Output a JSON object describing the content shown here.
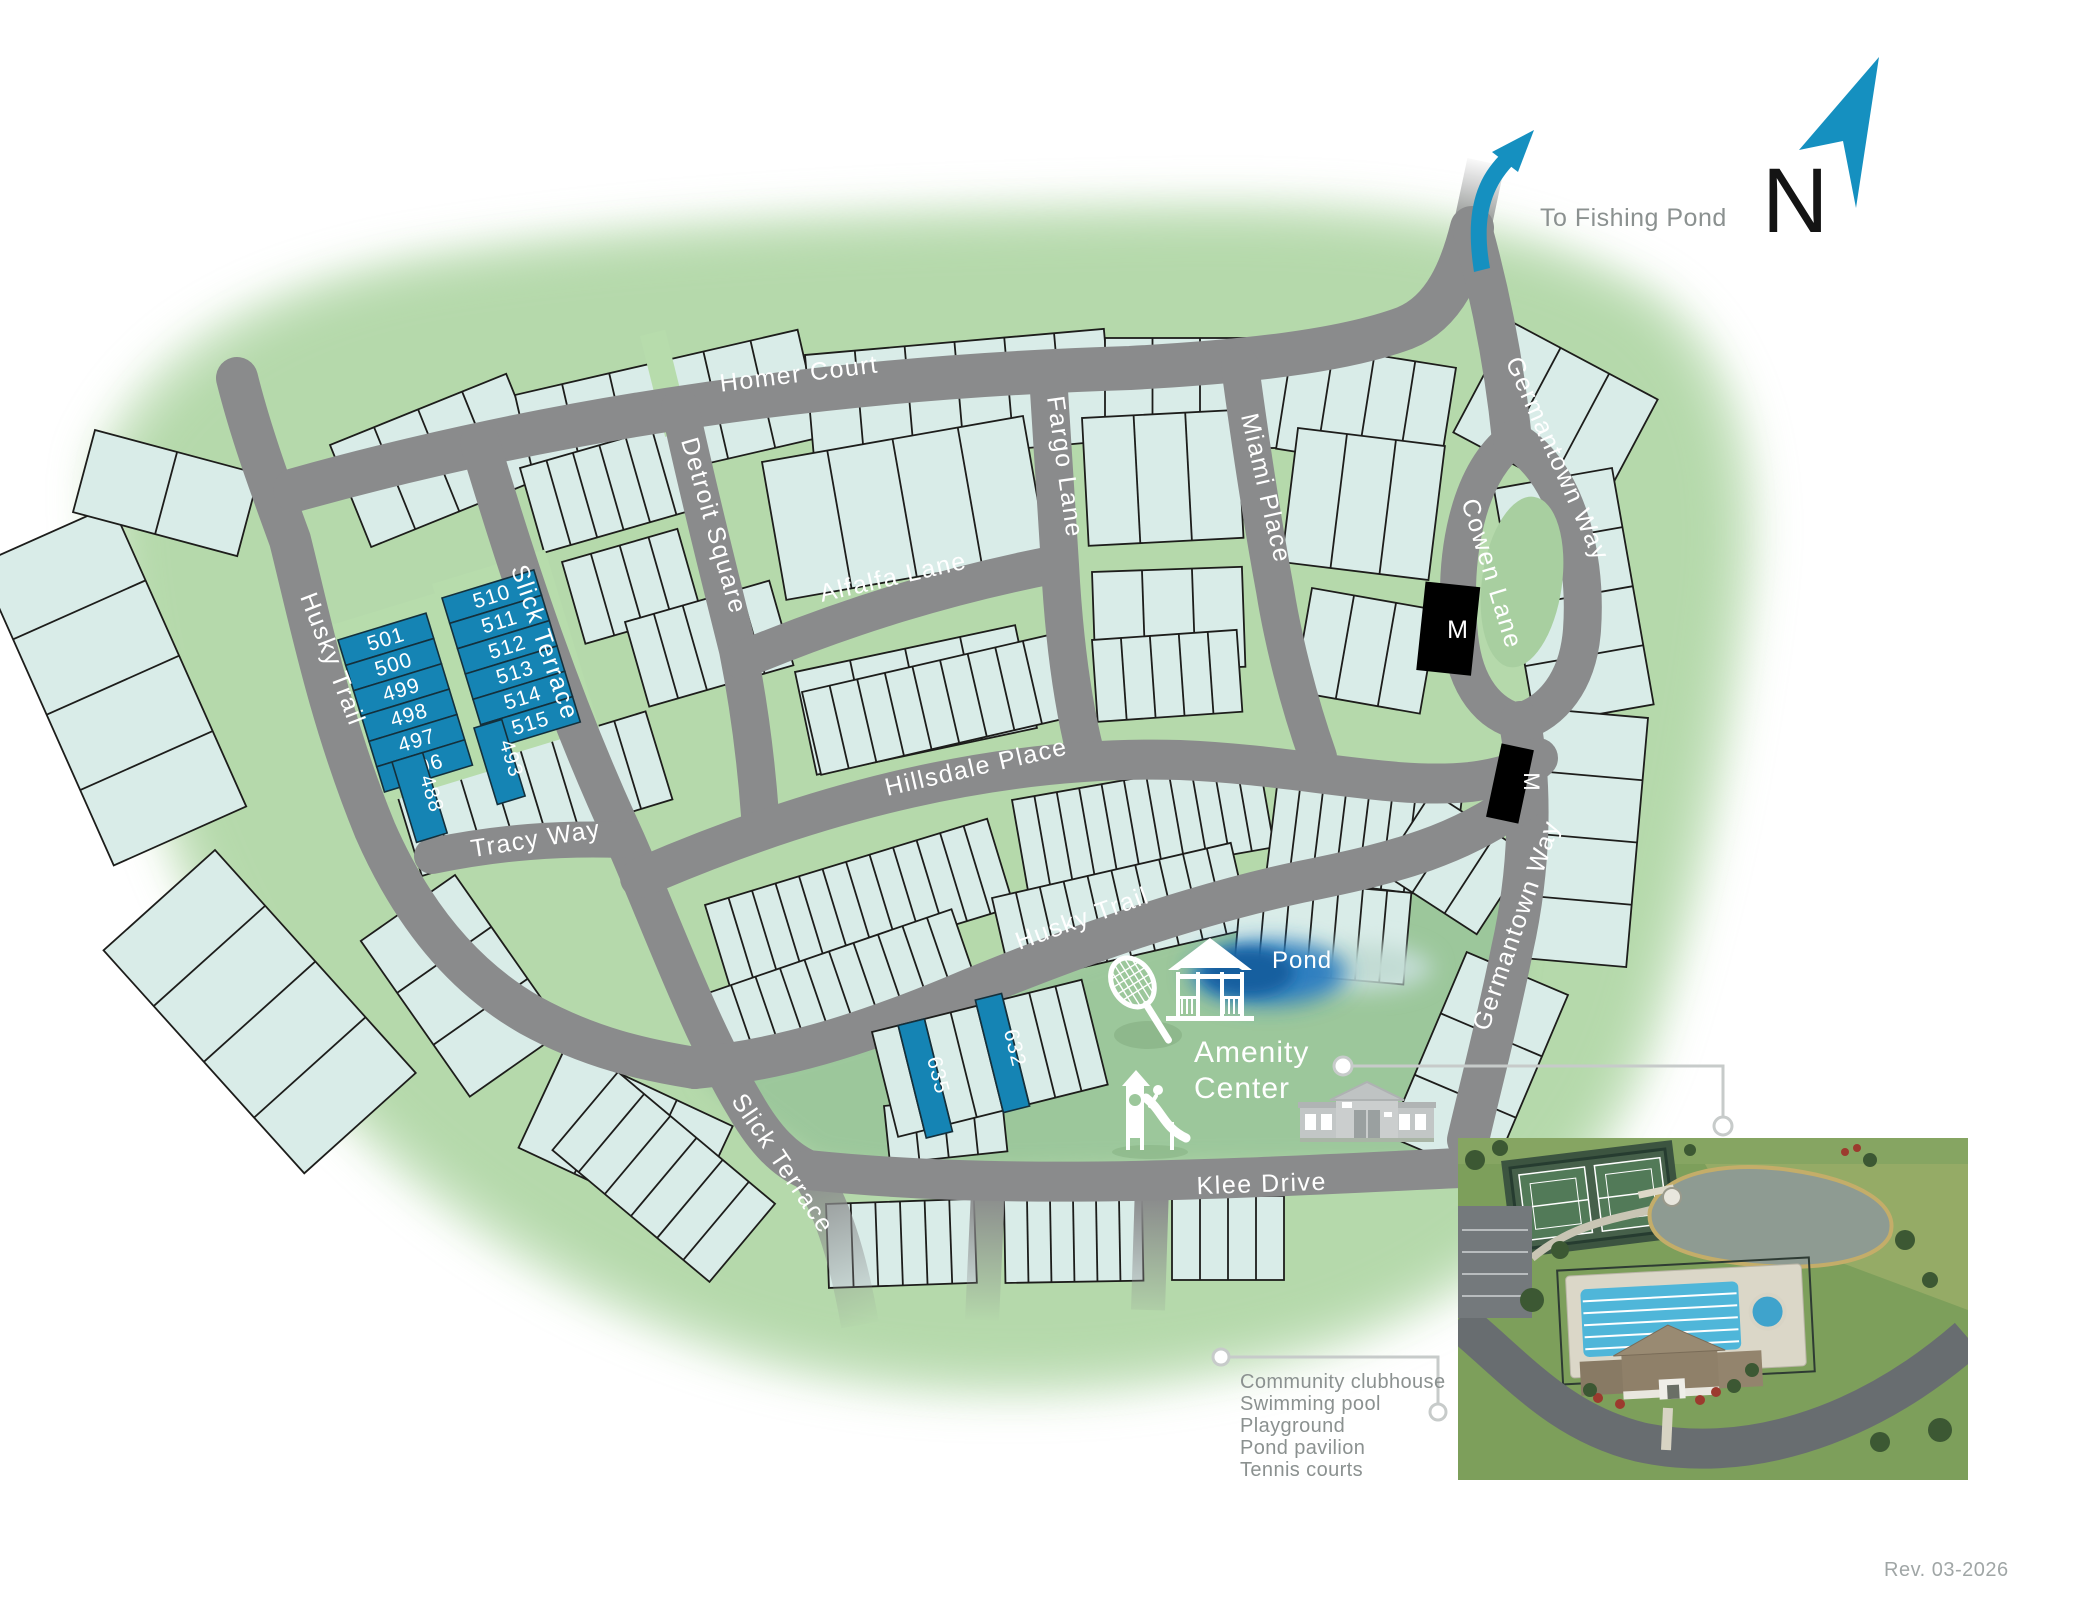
{
  "streets": {
    "homer_court": "Homer Court",
    "detroit_square": "Detroit Square",
    "slick_terrace_1": "Slick Terrace",
    "slick_terrace_2": "Slick Terrace",
    "alfalfa_lane": "Alfalfa Lane",
    "fargo_lane": "Fargo Lane",
    "miami_place": "Miami Place",
    "cowen_lane": "Cowen Lane",
    "germantown_way_1": "Germantown Way",
    "germantown_way_2": "Germantown Way",
    "hillsdale_place": "Hillsdale Place",
    "husky_trail_1": "Husky Trail",
    "husky_trail_2": "Husky Trail",
    "tracy_way": "Tracy Way",
    "klee_drive": "Klee Drive"
  },
  "lots": {
    "group_west": [
      "501",
      "500",
      "499",
      "498",
      "497",
      "496"
    ],
    "group_east": [
      "510",
      "511",
      "512",
      "513",
      "514",
      "515"
    ],
    "lot_488": "488",
    "lot_493": "493",
    "lot_635": "635",
    "lot_632": "632"
  },
  "markers": {
    "model_home": "M"
  },
  "labels": {
    "pond": "Pond",
    "amenity_line1": "Amenity",
    "amenity_line2": "Center",
    "to_fishing_pond": "To Fishing Pond",
    "north": "N",
    "revision": "Rev. 03-2026"
  },
  "legend": {
    "items": [
      "Community clubhouse",
      "Swimming pool",
      "Playground",
      "Pond pavilion",
      "Tennis courts"
    ]
  },
  "colors": {
    "available_lot_blue": "#1584b4",
    "road_gray": "#8a8b8c",
    "lot_fill_mint": "#d9ece8",
    "greenspace": "#b5d9ab",
    "amenity_green": "#9cc79b",
    "model_lot_black": "#000000",
    "pond_blue": "#1a67ad",
    "arrow_blue": "#1590c0"
  }
}
